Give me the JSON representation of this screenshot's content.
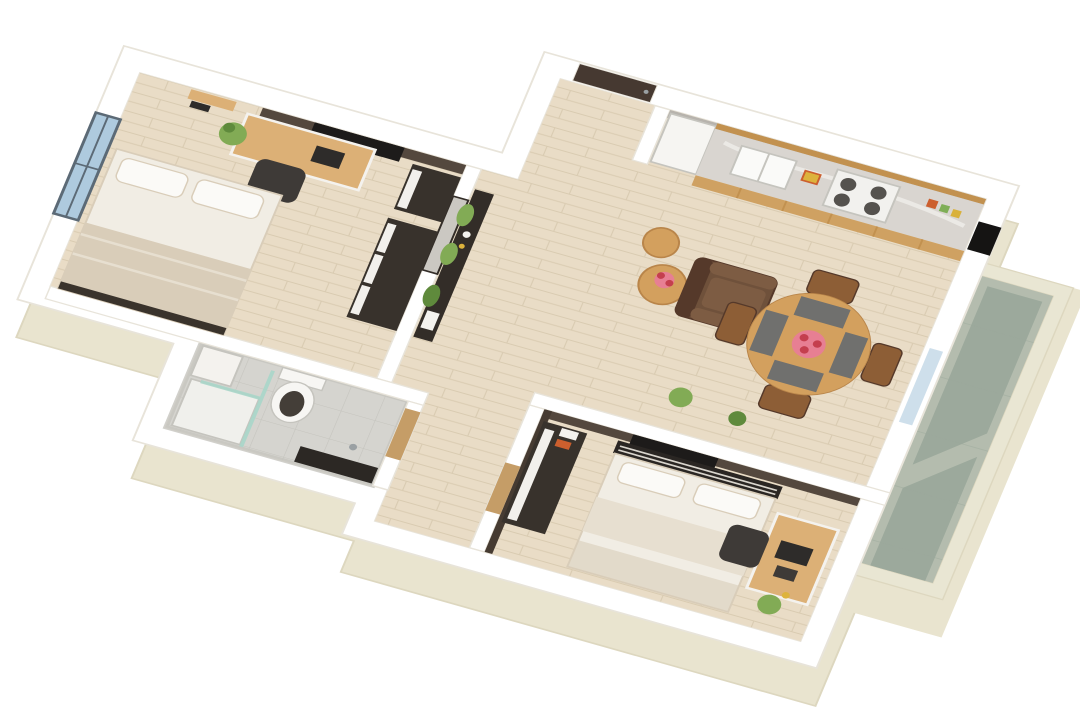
{
  "scene": {
    "type": "3d-floor-plan-render",
    "view": "axonometric-top",
    "rotation_deg": 19,
    "rooms": [
      {
        "id": "bedroom-1",
        "position": "top-left",
        "furniture": [
          "window",
          "wall-shelves",
          "desk",
          "laptop",
          "desk-chair",
          "potted-plant",
          "tv-panel",
          "dresser",
          "wardrobe",
          "double-bed",
          "pillows",
          "blanket"
        ]
      },
      {
        "id": "bathroom",
        "position": "center-left",
        "furniture": [
          "glass-shower",
          "shower-tray",
          "toilet",
          "vanity-counter",
          "washer-cabinet",
          "wood-door",
          "floor-drain"
        ]
      },
      {
        "id": "hallway",
        "position": "center",
        "furniture": [
          "entry-door",
          "console-table",
          "mirror",
          "hanging-plants",
          "decor-items"
        ]
      },
      {
        "id": "kitchen-living",
        "position": "right",
        "furniture": [
          "fridge",
          "counter-run",
          "sink",
          "gas-hob",
          "upper-cabinets",
          "ac-unit",
          "armchair",
          "side-tables",
          "flower-vase",
          "dining-table",
          "dining-chairs",
          "placemats",
          "flower-centerpiece",
          "potted-plants"
        ]
      },
      {
        "id": "bedroom-2",
        "position": "bottom-center",
        "furniture": [
          "accent-wall",
          "tv-panel",
          "headboard-bench",
          "double-bed",
          "pillows",
          "desk",
          "laptop",
          "desk-chair",
          "wardrobe",
          "shelf-boxes",
          "wood-door",
          "potted-plant"
        ]
      },
      {
        "id": "balcony",
        "position": "right-edge",
        "furniture": [
          "tile-floor",
          "glass-slider"
        ]
      }
    ]
  },
  "colors": {
    "background": "#ffffff",
    "wallTop": "#ffffff",
    "wallEdge": "#e8e4da",
    "creamWall": "#e9e4cf",
    "creamWallShade": "#ddd7bf",
    "floorWood": "#e9dcc6",
    "floorWoodLine": "#d9cbb1",
    "floorTile": "#d5d4cf",
    "floorTileLine": "#c5c4be",
    "balconyFloor": "#b4bcae",
    "balconyFloorDark": "#9ca99c",
    "balconyWall": "#e9e6d3",
    "accentWall": "#54483e",
    "accentWallDark": "#463b32",
    "kitchenWallBand": "#b7b3ad",
    "counterMarble": "#d9d5d0",
    "counterVein": "#efedea",
    "kitchenWood": "#cfa162",
    "kitchenWoodDark": "#c2914f",
    "fridgeWhite": "#f6f5f2",
    "sinkWhite": "#fafaf8",
    "hobWhite": "#f2f1ee",
    "burnerDark": "#55524e",
    "tvBlack": "#1d1b1a",
    "doorWood": "#c59d67",
    "doorDark": "#463931",
    "consoleDark": "#332d28",
    "mirrorGlass": "#cbc8c2",
    "plantGreen": "#82ab55",
    "plantGreenDark": "#5f8a3c",
    "sofaBrown": "#6f513b",
    "sofaBrownDark": "#55392a",
    "sofaCushion": "#7d5c43",
    "tableWood": "#d3a05e",
    "tableWoodEdge": "#b9854a",
    "chairWood": "#8d5e36",
    "placemat": "#70706e",
    "flowerPink": "#e77f93",
    "flowerRed": "#c43f4e",
    "bedSheet": "#f1ede4",
    "bedBlanket": "#d9cdb9",
    "bedFold": "#e7dfd0",
    "pillowWhite": "#fbfaf7",
    "bedFootDark": "#3a332c",
    "headboardSlat": "#d9d5cd",
    "headboardDark": "#2a2623",
    "wardrobeDark": "#38322c",
    "wardrobeDoorWhite": "#f2f0ec",
    "deskWood": "#dcb076",
    "chairDark": "#3e3a37",
    "laptopDark": "#2e2c2a",
    "windowGlass": "#aecade",
    "windowFrame": "#5c6a76",
    "acBlack": "#151413",
    "metalGray": "#9aa0a3",
    "toiletWhite": "#f7f6f3",
    "toiletSeatDark": "#443e38",
    "vanityDark": "#2c2824",
    "showerGlass": "#a9d6c9",
    "trayWhite": "#f0f0ec",
    "accentYellow": "#ddb33c",
    "accentOrange": "#cc5f2e",
    "boxWhite": "#f4f2ee",
    "jarGreen": "#7fae57",
    "jarAmber": "#d9b13b"
  }
}
